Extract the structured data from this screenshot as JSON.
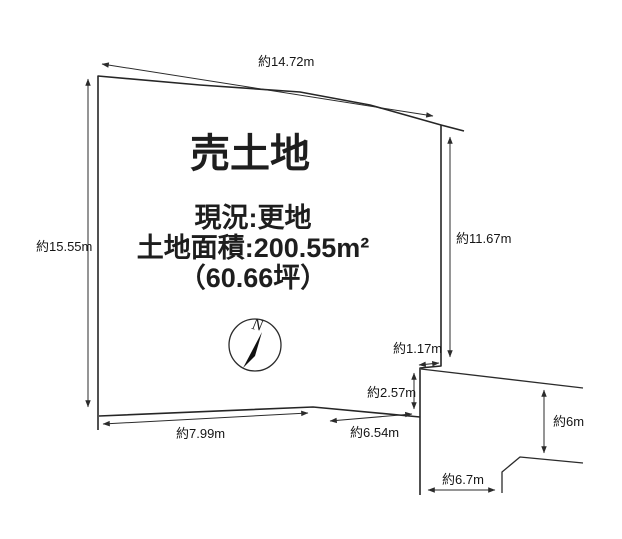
{
  "page": {
    "background_color": "#ffffff",
    "ink_color": "#1e1e1e"
  },
  "listing": {
    "title": "売土地",
    "status": "現況:更地",
    "area": "土地面積:200.55m²",
    "area_tsubo": "（60.66坪）"
  },
  "compass": {
    "north": "N"
  },
  "dimensions": {
    "top_edge": "約14.72m",
    "left_edge": "約15.55m",
    "right_edge": "約11.67m",
    "notch_width": "約1.17m",
    "notch_height": "約2.57m",
    "bottom_left_edge": "約7.99m",
    "bottom_right_edge": "約6.54m",
    "road_side": "約6m",
    "road_frontage": "約6.7m"
  }
}
